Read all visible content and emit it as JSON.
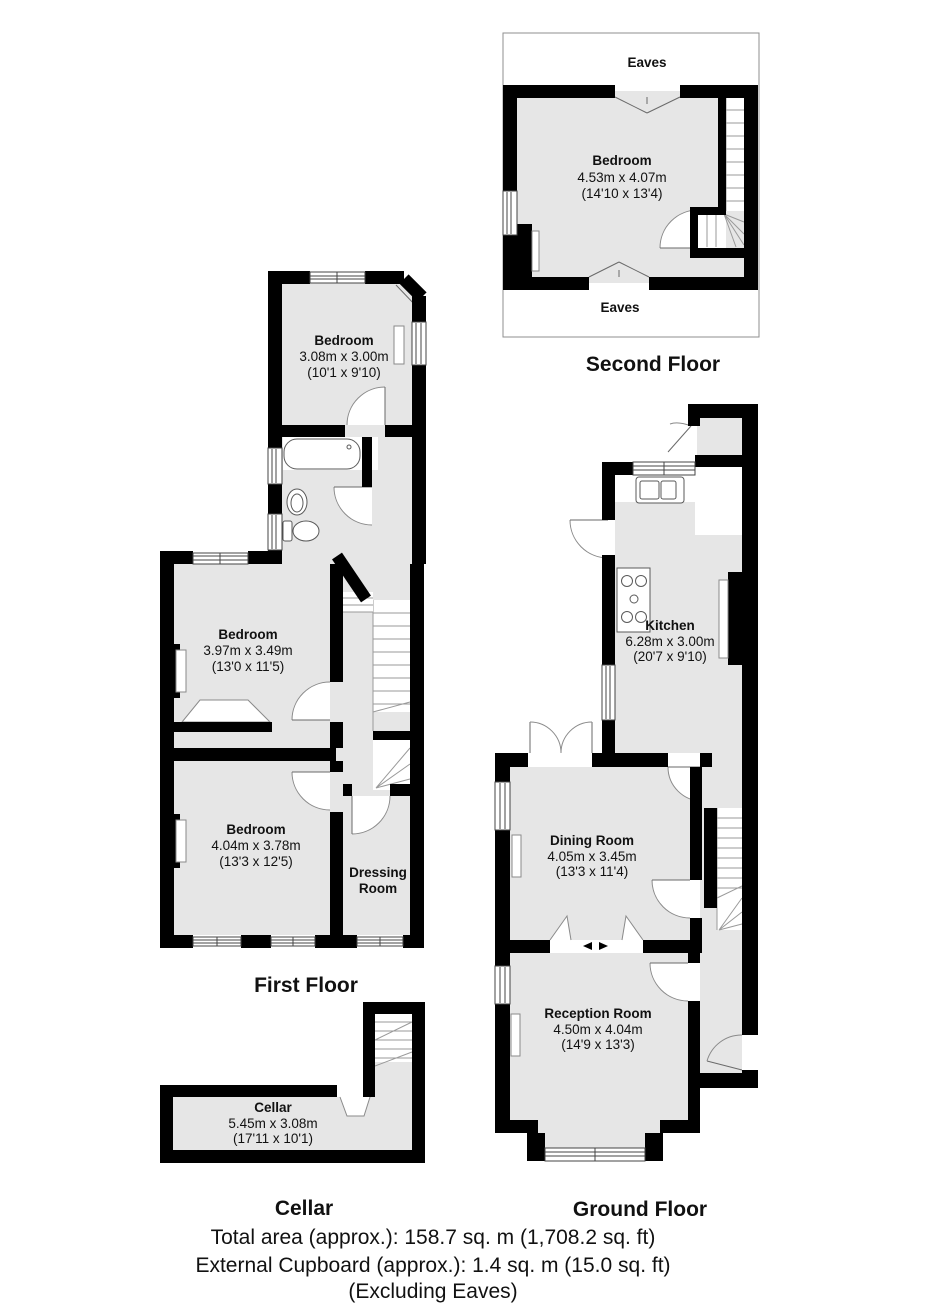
{
  "floors": {
    "second": {
      "title": "Second Floor",
      "eaves_top": "Eaves",
      "eaves_bottom": "Eaves",
      "bedroom": {
        "name": "Bedroom",
        "metric": "4.53m x 4.07m",
        "imperial": "(14'10 x 13'4)"
      }
    },
    "first": {
      "title": "First Floor",
      "bedroom_top": {
        "name": "Bedroom",
        "metric": "3.08m x 3.00m",
        "imperial": "(10'1 x 9'10)"
      },
      "bedroom_middle": {
        "name": "Bedroom",
        "metric": "3.97m x 3.49m",
        "imperial": "(13'0 x 11'5)"
      },
      "bedroom_bottom": {
        "name": "Bedroom",
        "metric": "4.04m x 3.78m",
        "imperial": "(13'3 x 12'5)"
      },
      "dressing_room": {
        "name_line1": "Dressing",
        "name_line2": "Room"
      }
    },
    "cellar": {
      "title": "Cellar",
      "cellar_room": {
        "name": "Cellar",
        "metric": "5.45m x 3.08m",
        "imperial": "(17'11 x 10'1)"
      }
    },
    "ground": {
      "title": "Ground Floor",
      "kitchen": {
        "name": "Kitchen",
        "metric": "6.28m x 3.00m",
        "imperial": "(20'7 x 9'10)"
      },
      "dining_room": {
        "name": "Dining Room",
        "metric": "4.05m x 3.45m",
        "imperial": "(13'3 x 11'4)"
      },
      "reception_room": {
        "name": "Reception Room",
        "metric": "4.50m x 4.04m",
        "imperial": "(14'9 x 13'3)"
      }
    }
  },
  "footer": {
    "total_area": "Total area (approx.): 158.7 sq. m (1,708.2 sq. ft)",
    "external_cupboard": "External Cupboard (approx.): 1.4 sq. m (15.0 sq. ft)",
    "excluding": "(Excluding Eaves)"
  },
  "colors": {
    "wall": "#000000",
    "floor_fill": "#e6e6e6",
    "detail_line": "#8a8a8a",
    "text": "#111111"
  }
}
